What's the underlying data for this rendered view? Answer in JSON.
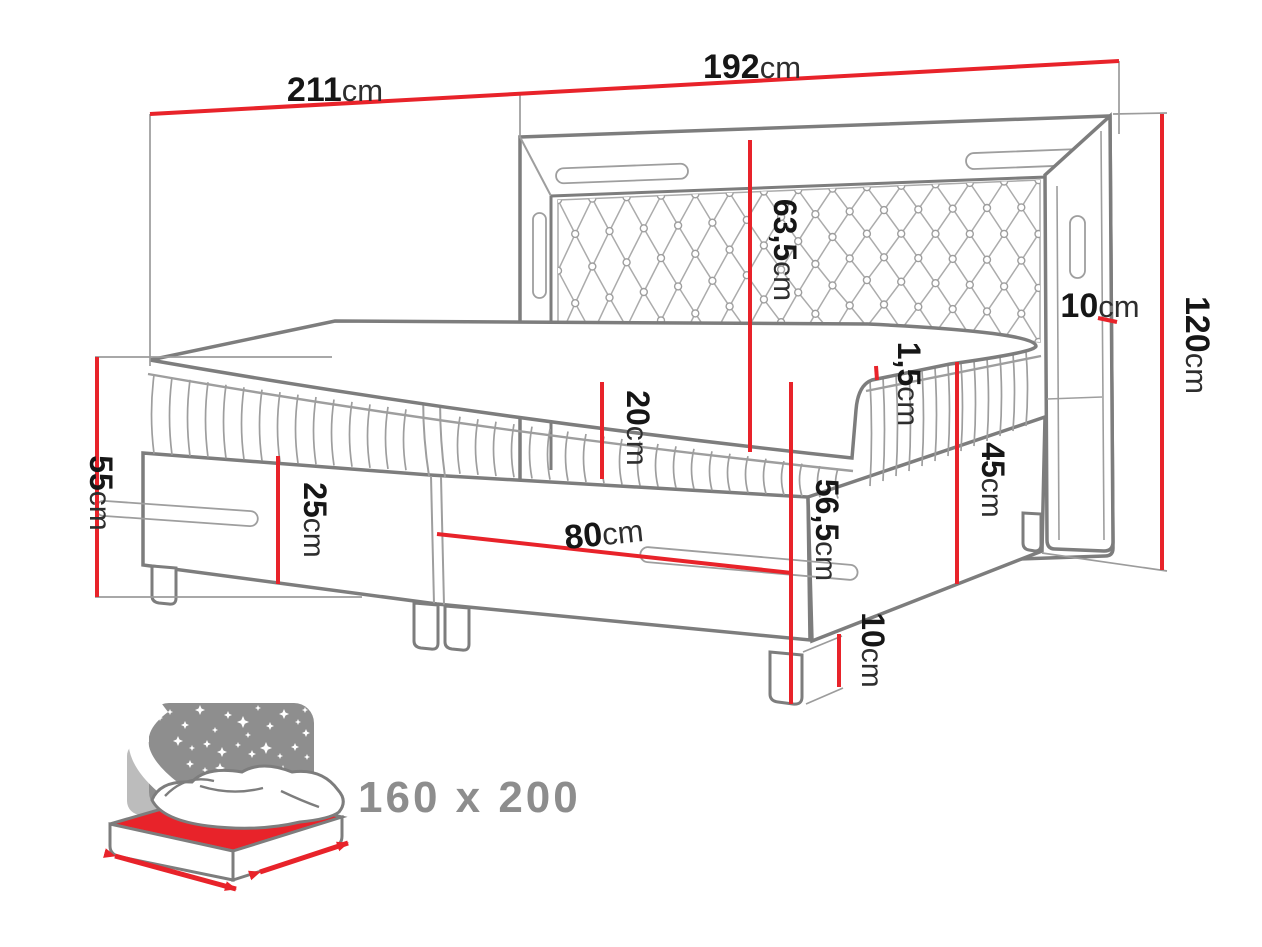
{
  "title": "Boxspring bed dimension diagram",
  "colors": {
    "accent": "#e8232a",
    "line_gray": "#7d7d7d",
    "night_panel_gray": "#8e8e8e",
    "badge_text_gray": "#8d8d8d"
  },
  "dims": {
    "bed_length_total": {
      "value": "211",
      "unit": "cm"
    },
    "headboard_width": {
      "value": "192",
      "unit": "cm"
    },
    "headboard_height": {
      "value": "120",
      "unit": "cm"
    },
    "frame_bar_width": {
      "value": "10",
      "unit": "cm"
    },
    "headboard_panel_height": {
      "value": "63,5",
      "unit": "cm"
    },
    "topper_thickness": {
      "value": "1,5",
      "unit": "cm"
    },
    "mattress_thickness": {
      "value": "20",
      "unit": "cm"
    },
    "mattress_top_height": {
      "value": "56,5",
      "unit": "cm"
    },
    "base_corner_height": {
      "value": "45",
      "unit": "cm"
    },
    "side_height": {
      "value": "55",
      "unit": "cm"
    },
    "drawer_front_height": {
      "value": "25",
      "unit": "cm"
    },
    "single_box_width": {
      "value": "80",
      "unit": "cm"
    },
    "leg_height": {
      "value": "10",
      "unit": "cm"
    }
  },
  "badge": {
    "size_text": "160 x 200"
  }
}
